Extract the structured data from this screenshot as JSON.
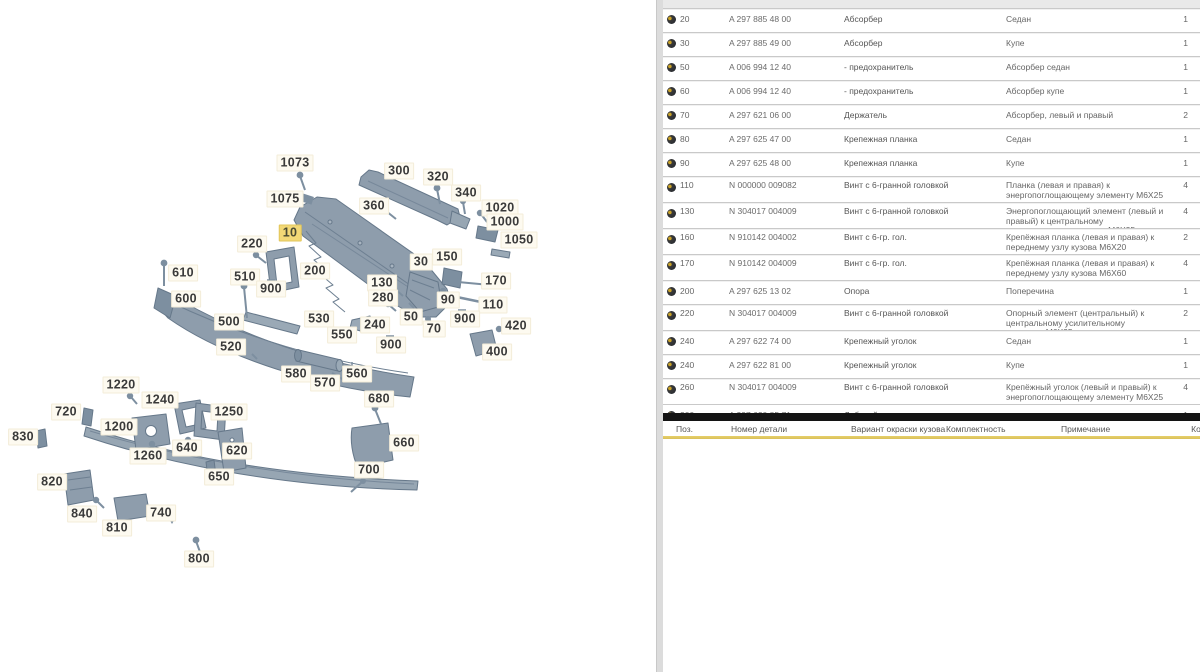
{
  "colors": {
    "part_fill": "#8e9dac",
    "part_stroke": "#66788a",
    "highlight_label_bg": "#f2d876",
    "gold_line": "#d9c05a",
    "black_bar": "#141414"
  },
  "diagram": {
    "highlighted_position": "10",
    "labels": [
      {
        "text": "1073",
        "x": 295,
        "y": 163,
        "hl": false
      },
      {
        "text": "1075",
        "x": 285,
        "y": 199,
        "hl": false
      },
      {
        "text": "300",
        "x": 399,
        "y": 171,
        "hl": false
      },
      {
        "text": "320",
        "x": 438,
        "y": 177,
        "hl": false
      },
      {
        "text": "340",
        "x": 466,
        "y": 193,
        "hl": false
      },
      {
        "text": "360",
        "x": 374,
        "y": 206,
        "hl": false
      },
      {
        "text": "1020",
        "x": 500,
        "y": 208,
        "hl": false
      },
      {
        "text": "1000",
        "x": 505,
        "y": 222,
        "hl": false
      },
      {
        "text": "1050",
        "x": 519,
        "y": 240,
        "hl": false
      },
      {
        "text": "220",
        "x": 252,
        "y": 244,
        "hl": false
      },
      {
        "text": "10",
        "x": 290,
        "y": 233,
        "hl": true
      },
      {
        "text": "200",
        "x": 315,
        "y": 271,
        "hl": false
      },
      {
        "text": "610",
        "x": 183,
        "y": 273,
        "hl": false
      },
      {
        "text": "510",
        "x": 245,
        "y": 277,
        "hl": false
      },
      {
        "text": "900",
        "x": 271,
        "y": 289,
        "hl": false
      },
      {
        "text": "600",
        "x": 186,
        "y": 299,
        "hl": false
      },
      {
        "text": "130",
        "x": 382,
        "y": 283,
        "hl": false
      },
      {
        "text": "30",
        "x": 421,
        "y": 262,
        "hl": false
      },
      {
        "text": "150",
        "x": 447,
        "y": 257,
        "hl": false
      },
      {
        "text": "170",
        "x": 496,
        "y": 281,
        "hl": false
      },
      {
        "text": "280",
        "x": 383,
        "y": 298,
        "hl": false
      },
      {
        "text": "90",
        "x": 448,
        "y": 300,
        "hl": false
      },
      {
        "text": "110",
        "x": 493,
        "y": 305,
        "hl": false
      },
      {
        "text": "500",
        "x": 229,
        "y": 322,
        "hl": false
      },
      {
        "text": "530",
        "x": 319,
        "y": 319,
        "hl": false
      },
      {
        "text": "240",
        "x": 375,
        "y": 325,
        "hl": false
      },
      {
        "text": "50",
        "x": 411,
        "y": 317,
        "hl": false
      },
      {
        "text": "900",
        "x": 465,
        "y": 319,
        "hl": false
      },
      {
        "text": "420",
        "x": 516,
        "y": 326,
        "hl": false
      },
      {
        "text": "550",
        "x": 342,
        "y": 335,
        "hl": false
      },
      {
        "text": "70",
        "x": 434,
        "y": 329,
        "hl": false
      },
      {
        "text": "520",
        "x": 231,
        "y": 347,
        "hl": false
      },
      {
        "text": "900",
        "x": 391,
        "y": 345,
        "hl": false
      },
      {
        "text": "400",
        "x": 497,
        "y": 352,
        "hl": false
      },
      {
        "text": "580",
        "x": 296,
        "y": 374,
        "hl": false
      },
      {
        "text": "570",
        "x": 325,
        "y": 383,
        "hl": false
      },
      {
        "text": "560",
        "x": 357,
        "y": 374,
        "hl": false
      },
      {
        "text": "1220",
        "x": 121,
        "y": 385,
        "hl": false
      },
      {
        "text": "680",
        "x": 379,
        "y": 399,
        "hl": false
      },
      {
        "text": "720",
        "x": 66,
        "y": 412,
        "hl": false
      },
      {
        "text": "1240",
        "x": 160,
        "y": 400,
        "hl": false
      },
      {
        "text": "1200",
        "x": 119,
        "y": 427,
        "hl": false
      },
      {
        "text": "1250",
        "x": 229,
        "y": 412,
        "hl": false
      },
      {
        "text": "830",
        "x": 23,
        "y": 437,
        "hl": false
      },
      {
        "text": "660",
        "x": 404,
        "y": 443,
        "hl": false
      },
      {
        "text": "1260",
        "x": 148,
        "y": 456,
        "hl": false
      },
      {
        "text": "640",
        "x": 187,
        "y": 448,
        "hl": false
      },
      {
        "text": "620",
        "x": 237,
        "y": 451,
        "hl": false
      },
      {
        "text": "700",
        "x": 369,
        "y": 470,
        "hl": false
      },
      {
        "text": "650",
        "x": 219,
        "y": 477,
        "hl": false
      },
      {
        "text": "820",
        "x": 52,
        "y": 482,
        "hl": false
      },
      {
        "text": "840",
        "x": 82,
        "y": 514,
        "hl": false
      },
      {
        "text": "740",
        "x": 161,
        "y": 513,
        "hl": false
      },
      {
        "text": "810",
        "x": 117,
        "y": 528,
        "hl": false
      },
      {
        "text": "800",
        "x": 199,
        "y": 559,
        "hl": false
      }
    ]
  },
  "table": {
    "rows": [
      {
        "pos": "20",
        "pn": "A 297 885 48 00",
        "name": "Абсорбер",
        "note": "Седан",
        "qty": "1",
        "tall": false
      },
      {
        "pos": "30",
        "pn": "A 297 885 49 00",
        "name": "Абсорбер",
        "note": "Купе",
        "qty": "1",
        "tall": false
      },
      {
        "pos": "50",
        "pn": "A 006 994 12 40",
        "name": "- предохранитель",
        "note": "Абсорбер седан",
        "qty": "1",
        "tall": false
      },
      {
        "pos": "60",
        "pn": "A 006 994 12 40",
        "name": "- предохранитель",
        "note": "Абсорбер купе",
        "qty": "1",
        "tall": false
      },
      {
        "pos": "70",
        "pn": "A 297 621 06 00",
        "name": "Держатель",
        "note": "Абсорбер, левый и правый",
        "qty": "2",
        "tall": false
      },
      {
        "pos": "80",
        "pn": "A 297 625 47 00",
        "name": "Крепежная планка",
        "note": "Седан",
        "qty": "1",
        "tall": false
      },
      {
        "pos": "90",
        "pn": "A 297 625 48 00",
        "name": "Крепежная планка",
        "note": "Купе",
        "qty": "1",
        "tall": false
      },
      {
        "pos": "110",
        "pn": "N 000000 009082",
        "name": "Винт с 6-гранной головкой",
        "note": "Планка (левая и правая) к энергопоглощающему элементу M6X25",
        "qty": "4",
        "tall": true
      },
      {
        "pos": "130",
        "pn": "N 304017 004009",
        "name": "Винт с 6-гранной головкой",
        "note": "Энергопоглощающий элемент (левый и правый) к центральному усилительному элементу M6X25",
        "qty": "4",
        "tall": true
      },
      {
        "pos": "160",
        "pn": "N 910142 004002",
        "name": "Винт с 6-гр. гол.",
        "note": "Крепёжная планка (левая и правая) к переднему узлу кузова M6X20",
        "qty": "2",
        "tall": true
      },
      {
        "pos": "170",
        "pn": "N 910142 004009",
        "name": "Винт с 6-гр. гол.",
        "note": "Крепёжная планка (левая и правая) к переднему узлу кузова M6X60",
        "qty": "4",
        "tall": true
      },
      {
        "pos": "200",
        "pn": "A 297 625 13 02",
        "name": "Опора",
        "note": "Поперечина",
        "qty": "1",
        "tall": false
      },
      {
        "pos": "220",
        "pn": "N 304017 004009",
        "name": "Винт с 6-гранной головкой",
        "note": "Опорный элемент (центральный) к центральному усилительному элементу M6X25",
        "qty": "2",
        "tall": true
      },
      {
        "pos": "240",
        "pn": "A 297 622 74 00",
        "name": "Крепежный уголок",
        "note": "Седан",
        "qty": "1",
        "tall": false
      },
      {
        "pos": "240",
        "pn": "A 297 622 81 00",
        "name": "Крепежный уголок",
        "note": "Купе",
        "qty": "1",
        "tall": false
      },
      {
        "pos": "260",
        "pn": "N 304017 004009",
        "name": "Винт с 6-гранной головкой",
        "note": "Крепёжный уголок (левый и правый) к энергопоглощающему элементу M6X25",
        "qty": "4",
        "tall": true
      }
    ],
    "partial_row": {
      "pos": "300",
      "pn": "A 297 620 85 71",
      "name": "Лобовой элемент",
      "note": "",
      "qty": "1"
    },
    "header2": {
      "pos": "Поз.",
      "part_number": "Номер детали",
      "col3": "Вариант окраски кузова",
      "col4": "Комплектность",
      "col5": "Примечание",
      "qty": "Кол."
    }
  }
}
